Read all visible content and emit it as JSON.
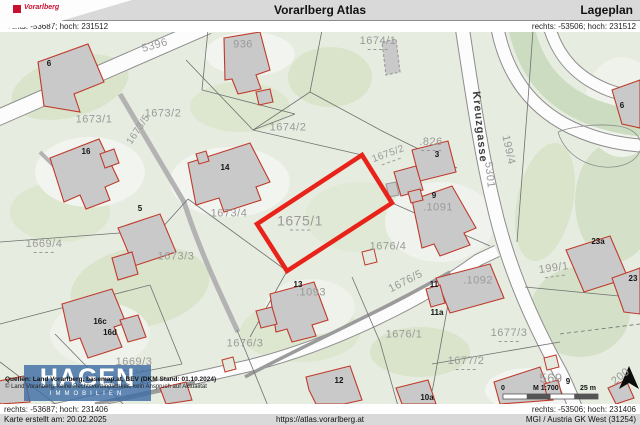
{
  "header": {
    "logo_text": "Vorarlberg",
    "title": "Vorarlberg Atlas",
    "page_type": "Lageplan"
  },
  "coordinates": {
    "top_left": "rechts: -53687; hoch: 231512",
    "top_right": "rechts: -53506; hoch: 231512",
    "bottom_left": "rechts: -53687; hoch: 231406",
    "bottom_right": "rechts: -53506; hoch: 231406"
  },
  "footer": {
    "created": "Karte erstellt am: 20.02.2025",
    "url": "https://atlas.vorarlberg.at",
    "crs": "MGI / Austria GK West (31254)"
  },
  "map": {
    "selected_parcel": "1675/1",
    "street_name": "Kreuzgasse",
    "watermark": {
      "title": "HAGEN",
      "subtitle": "IMMOBILIEN"
    },
    "sources_line1": "Quellen: Land Vorarlberg, basemap.at, BEV (DKM Stand: 01.10.2024)",
    "sources_line2": "© Land Vorarlberg; keine Rechtsverbindlichkeit, kein Anspruch auf Aktualität",
    "scale": {
      "zero": "0",
      "ratio": "M 1:700",
      "distance": "25 m"
    },
    "colors": {
      "selection_red": "#e8231a",
      "building_outline": "#c0392b",
      "building_fill": "#c9c9c9",
      "parcel_label": "#9a9a9a",
      "map_background": "#e6ecdf",
      "watermark_blue": "#3e6ea5",
      "header_bar": "#d9d9d9"
    },
    "parcel_labels": [
      {
        "text": "5396",
        "x": 155,
        "y": 14,
        "rot": -16
      },
      {
        "text": "936",
        "x": 243,
        "y": 13
      },
      {
        "text": "1674/1",
        "x": 378,
        "y": 11,
        "dashed": true
      },
      {
        "text": "1673/1",
        "x": 94,
        "y": 88
      },
      {
        "text": "1673/5",
        "x": 139,
        "y": 98,
        "rot": -56,
        "size": 10
      },
      {
        "text": "1673/2",
        "x": 163,
        "y": 82
      },
      {
        "text": "1674/2",
        "x": 288,
        "y": 96
      },
      {
        "text": "Kreuzgasse",
        "x": 479,
        "y": 95,
        "rot": 84,
        "cls": "street"
      },
      {
        "text": "5301",
        "x": 489,
        "y": 143,
        "rot": 84
      },
      {
        "text": "199/4",
        "x": 508,
        "y": 118,
        "rot": 78
      },
      {
        "text": ".826",
        "x": 431,
        "y": 112,
        "dashed": true
      },
      {
        "text": "1675/2",
        "x": 389,
        "y": 124,
        "rot": -20,
        "size": 10,
        "dashed": true
      },
      {
        "text": ".1091",
        "x": 438,
        "y": 176
      },
      {
        "text": "1673/4",
        "x": 229,
        "y": 182
      },
      {
        "text": "1673/3",
        "x": 176,
        "y": 225
      },
      {
        "text": "1669/4",
        "x": 44,
        "y": 214,
        "dashed": true
      },
      {
        "text": "1675/1",
        "x": 300,
        "y": 190,
        "size": 14,
        "dashed": true
      },
      {
        "text": "1669/3",
        "x": 134,
        "y": 332,
        "dashed": true
      },
      {
        "text": "1676/3",
        "x": 245,
        "y": 312
      },
      {
        "text": ".1093",
        "x": 311,
        "y": 261
      },
      {
        "text": "1676/4",
        "x": 388,
        "y": 215
      },
      {
        "text": "1676/5",
        "x": 406,
        "y": 250,
        "rot": -27
      },
      {
        "text": ".1092",
        "x": 478,
        "y": 249
      },
      {
        "text": "199/1",
        "x": 554,
        "y": 238,
        "rot": -8,
        "dashed": true
      },
      {
        "text": "1676/1",
        "x": 404,
        "y": 303
      },
      {
        "text": "1677/3",
        "x": 509,
        "y": 303,
        "dashed": true
      },
      {
        "text": "1677/2",
        "x": 466,
        "y": 331,
        "dashed": true
      },
      {
        "text": "569",
        "x": 551,
        "y": 346,
        "size": 13
      },
      {
        "text": "200",
        "x": 621,
        "y": 345,
        "rot": -38
      }
    ],
    "house_numbers": [
      {
        "text": "6",
        "x": 49,
        "y": 32
      },
      {
        "text": "16",
        "x": 86,
        "y": 120
      },
      {
        "text": "14",
        "x": 225,
        "y": 136
      },
      {
        "text": "3",
        "x": 437,
        "y": 123
      },
      {
        "text": "9",
        "x": 434,
        "y": 164
      },
      {
        "text": "5",
        "x": 140,
        "y": 177
      },
      {
        "text": "16c",
        "x": 100,
        "y": 290
      },
      {
        "text": "16d",
        "x": 110,
        "y": 301
      },
      {
        "text": "13",
        "x": 298,
        "y": 253
      },
      {
        "text": "11",
        "x": 434,
        "y": 253
      },
      {
        "text": "11a",
        "x": 437,
        "y": 281
      },
      {
        "text": "23a",
        "x": 598,
        "y": 210
      },
      {
        "text": "23",
        "x": 633,
        "y": 247
      },
      {
        "text": "12",
        "x": 339,
        "y": 349
      },
      {
        "text": "10a",
        "x": 427,
        "y": 366
      },
      {
        "text": "9",
        "x": 568,
        "y": 350
      },
      {
        "text": "6",
        "x": 622,
        "y": 74
      }
    ]
  }
}
